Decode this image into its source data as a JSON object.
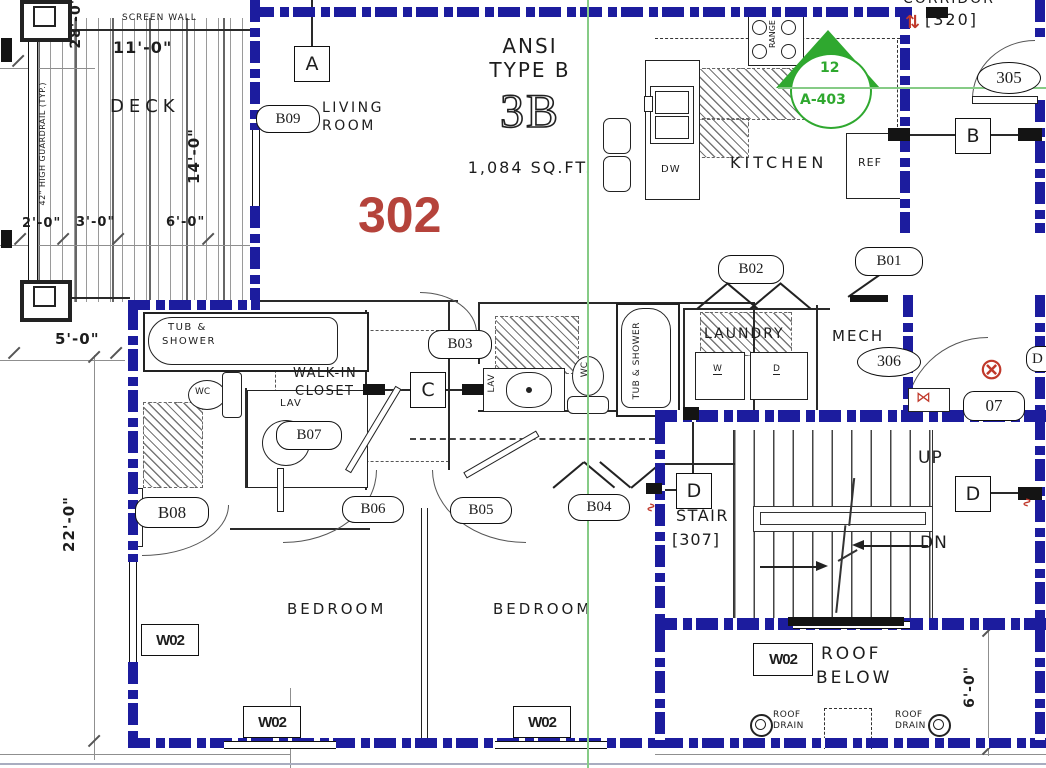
{
  "unit": {
    "number": "302",
    "ansi_line1": "ANSI",
    "ansi_line2": "TYPE B",
    "type_code": "3B",
    "area": "1,084 SQ.FT."
  },
  "rooms": {
    "living_line1": "LIVING",
    "living_line2": "ROOM",
    "deck": "DECK",
    "kitchen": "KITCHEN",
    "laundry": "LAUNDRY",
    "mech": "MECH",
    "mech_tag": "306",
    "walkin_line1": "WALK-IN",
    "walkin_line2": "CLOSET",
    "bedroom1": "BEDROOM",
    "bedroom2": "BEDROOM",
    "stair": "STAIR",
    "stair_tag": "[307]",
    "corridor": "CORRIDOR",
    "corridor_tag": "[320]",
    "corridor_door_tag": "305",
    "roof_line1": "ROOF",
    "roof_line2": "BELOW"
  },
  "door_tags": {
    "b01": "B01",
    "b02": "B02",
    "b03": "B03",
    "b04": "B04",
    "b05": "B05",
    "b06": "B06",
    "b07": "B07",
    "b08": "B08",
    "b09": "B09",
    "mech_door": "07",
    "partial_right": "D"
  },
  "window_tag": "W02",
  "grid_markers": {
    "a": "A",
    "b": "B",
    "c": "C",
    "d_stair": "D",
    "d_right": "D"
  },
  "section_marker": {
    "number": "12",
    "sheet": "A-403"
  },
  "fixtures": {
    "tub_line1": "TUB &",
    "tub_line2": "SHOWER",
    "wc": "WC",
    "lav": "LAV",
    "washer": "W",
    "dryer": "D",
    "dishwasher": "DW",
    "refrigerator": "REF",
    "range": "RANGE"
  },
  "stair_notes": {
    "up": "UP",
    "down": "DN"
  },
  "roof_notes": {
    "drain_line1": "ROOF",
    "drain_line2": "DRAIN"
  },
  "dimensions": {
    "deck_width": "28'-0\"",
    "screen_wall_width": "11'-0\"",
    "deck_depth": "14'-0\"",
    "seg_2": "2'-0\"",
    "seg_3": "3'-0\"",
    "seg_6": "6'-0\"",
    "side_5": "5'-0\"",
    "side_22": "22'-0\"",
    "roof_6": "6'-0\""
  },
  "notes": {
    "screen_wall": "SCREEN WALL",
    "guardrail": "42\" HIGH GUARDRAIL (TYP.)"
  },
  "symbols": {
    "revision": "⇅",
    "keynote": "⊗",
    "valve": "⋈",
    "squiggle": "∿"
  },
  "colors": {
    "wall_blue": "#1c1c9e",
    "accent_red": "#b5433b",
    "marker_green": "#2fa82f",
    "line_green": "#86cb86"
  }
}
